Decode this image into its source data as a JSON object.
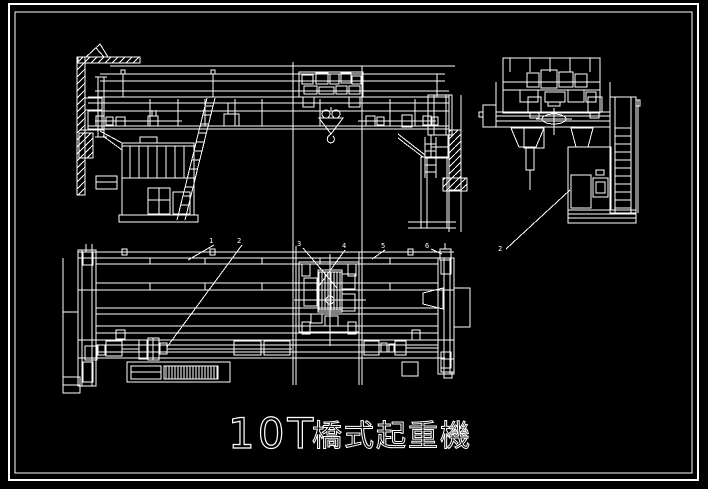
{
  "drawing": {
    "title": "10T 橋式起重機",
    "title_prefix": "10T",
    "title_name": "橋式起重機",
    "background_color": "#000000",
    "line_color": "#ffffff",
    "callouts": {
      "plan": [
        {
          "label": "1"
        },
        {
          "label": "2"
        },
        {
          "label": "3"
        },
        {
          "label": "4"
        },
        {
          "label": "5"
        },
        {
          "label": "6"
        }
      ],
      "side": [
        {
          "label": "2"
        }
      ]
    }
  }
}
